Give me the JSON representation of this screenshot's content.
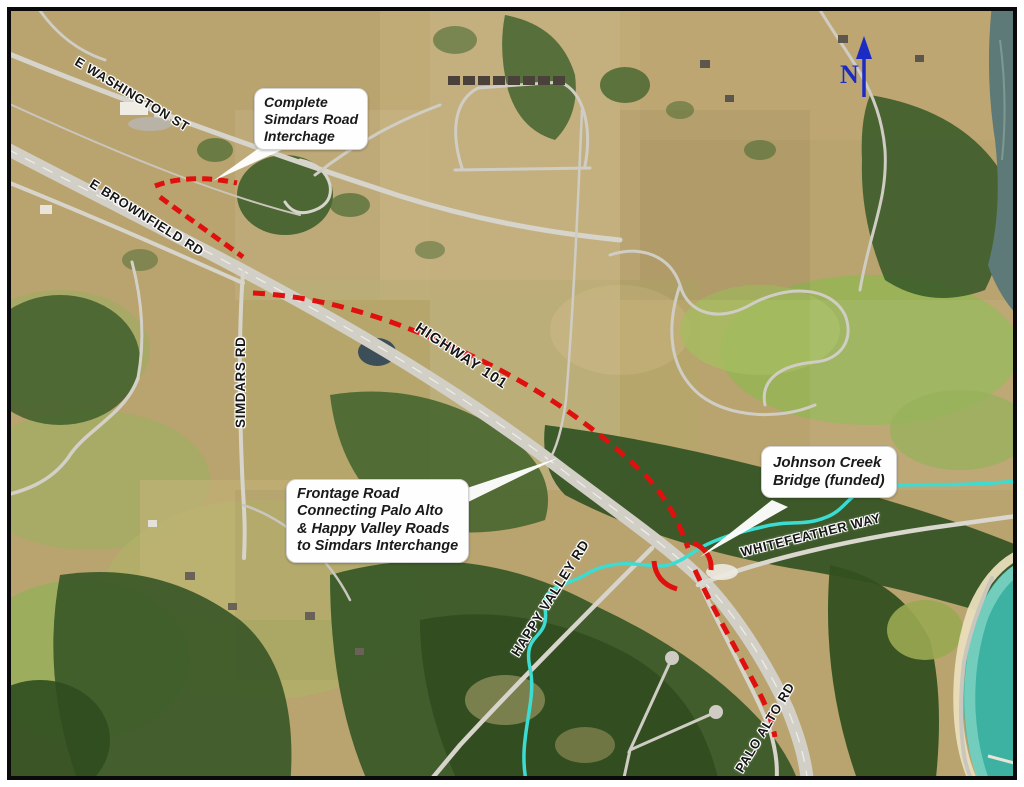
{
  "map": {
    "road_labels": [
      {
        "text": "E WASHINGTON ST"
      },
      {
        "text": "E BROWNFIELD RD"
      },
      {
        "text": "SIMDARS RD"
      },
      {
        "text": "HIGHWAY 101"
      },
      {
        "text": "WHITEFEATHER WAY"
      },
      {
        "text": "HAPPY VALLEY RD"
      },
      {
        "text": "PALO ALTO RD"
      }
    ],
    "callouts": [
      {
        "text": "Complete\nSimdars Road\nInterchage"
      },
      {
        "text": "Frontage Road\nConnecting Palo Alto\n& Happy Valley Roads\nto Simdars Interchange"
      },
      {
        "text": "Johnson Creek\nBridge (funded)"
      }
    ],
    "north_arrow": {
      "label": "N",
      "color": "#1b2bc4"
    },
    "colors": {
      "proposed_route_red": "#e0100e",
      "creek_highlight": "#3bdcd2",
      "bay_water": "#3eb2a2",
      "north_arrow_blue": "#1b2bc4"
    }
  }
}
